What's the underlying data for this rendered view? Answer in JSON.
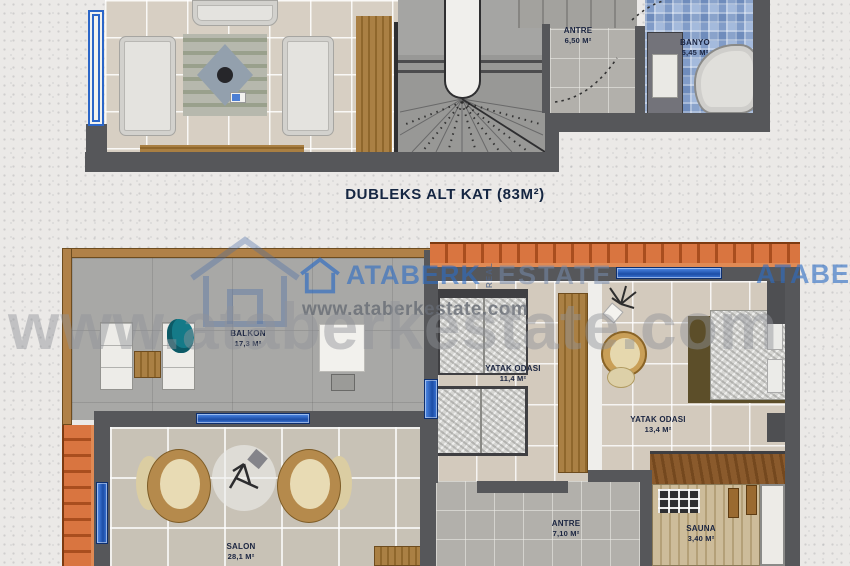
{
  "upper_plan": {
    "caption": "DUBLEKS ALT KAT (83M²)",
    "rooms": {
      "antre": {
        "name": "ANTRE",
        "area": "6,50 M²"
      },
      "banyo": {
        "name": "BANYO",
        "area": "5,45 M²"
      }
    }
  },
  "lower_plan": {
    "rooms": {
      "balkon": {
        "name": "BALKON",
        "area": "17,3 M²"
      },
      "yatak_odasi_1": {
        "name": "YATAK ODASI",
        "area": "11,4 M²"
      },
      "yatak_odasi_2": {
        "name": "YATAK ODASI",
        "area": "13,4 M²"
      },
      "salon": {
        "name": "SALON",
        "area": "28,1 M²"
      },
      "antre": {
        "name": "ANTRE",
        "area": "7,10 M²"
      },
      "sauna": {
        "name": "SAUNA",
        "area": "3,40 M²"
      }
    }
  },
  "watermark": {
    "brand_first": "ATABERK",
    "brand_real": "REAL",
    "brand_second": "ESTATE",
    "url_small": "www.ataberkestate.com",
    "url_large": "www.ataberkestate.com"
  },
  "colors": {
    "wall": "#56575a",
    "window_blue": "#2b66c8",
    "roof_tile_orange": "#d97540",
    "bathroom_mosaic_blue": "#8aa3cb",
    "label_navy": "#1b2541",
    "watermark_blue": "#2d6cc4"
  }
}
